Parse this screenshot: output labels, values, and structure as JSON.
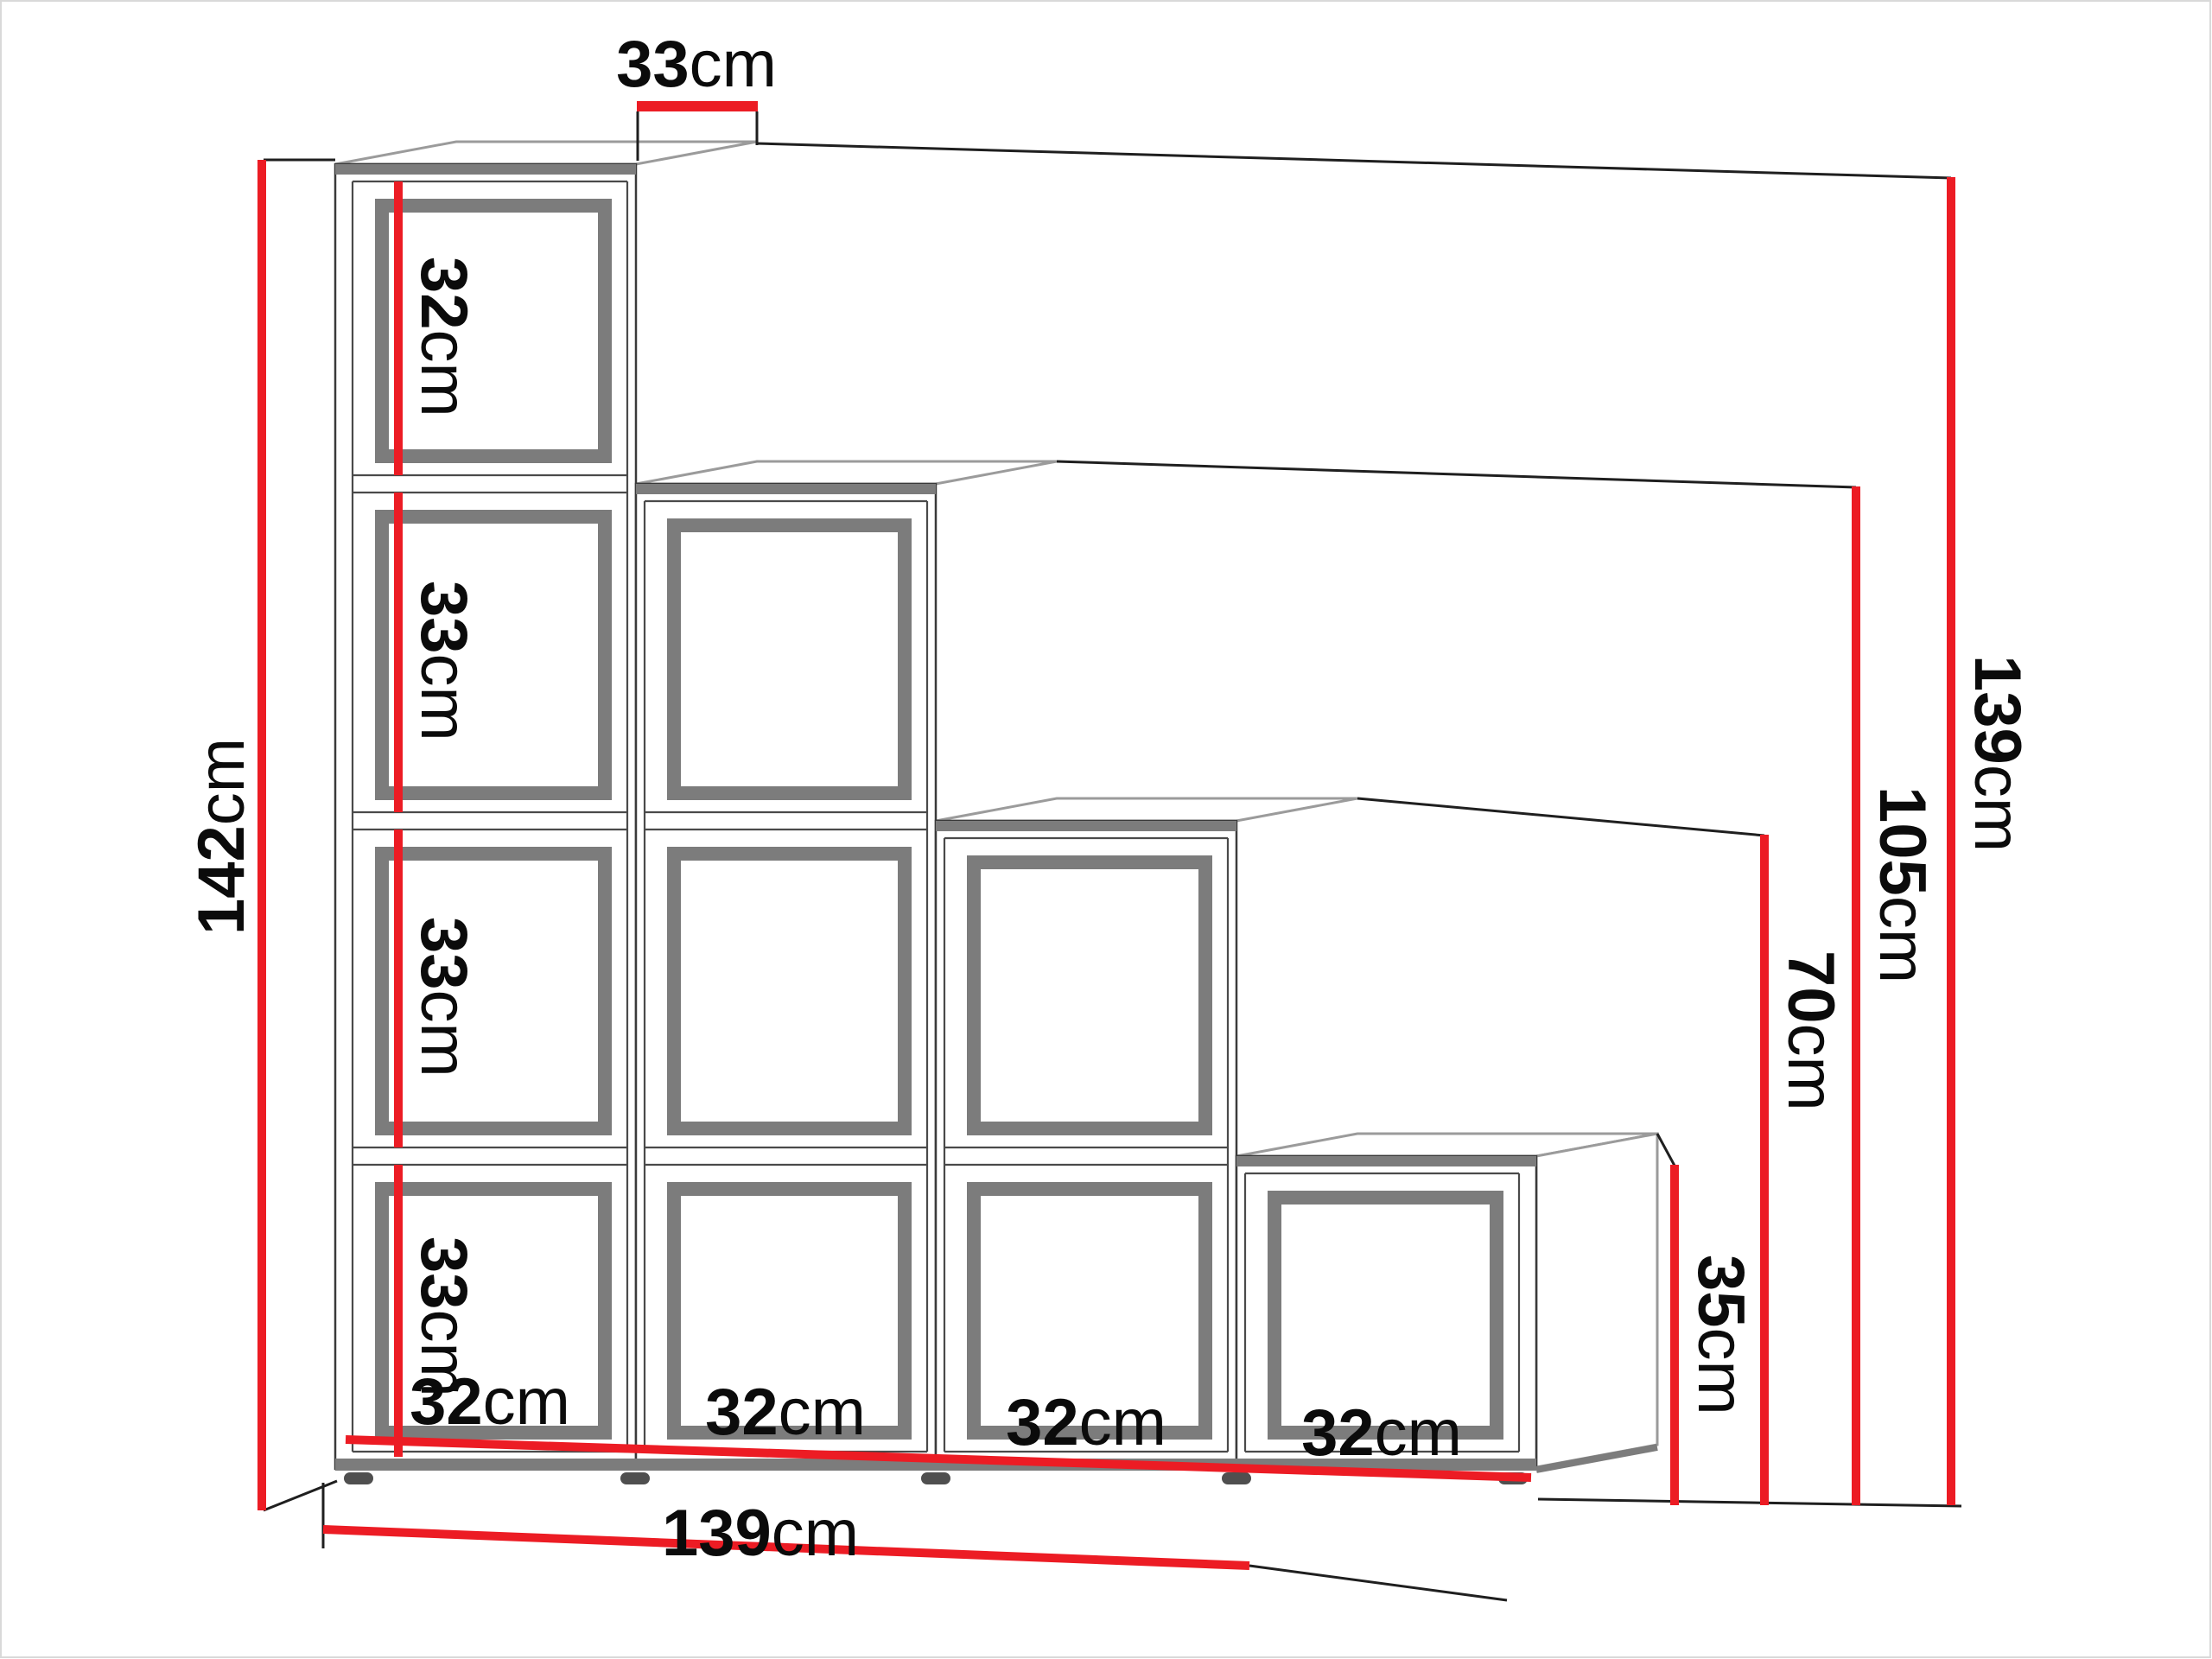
{
  "figure": {
    "kind": "furniture dimension diagram",
    "product": "staircase cube shelf (4 steps, 10 cubes)",
    "colors": {
      "dimension_red": "#ec1c24",
      "carcass_grey": "#7c7c7c",
      "edge_grey": "#9b9b9b",
      "line_black": "#1f1f1f",
      "background": "#ffffff"
    },
    "dims": {
      "depth_top": {
        "value": "33",
        "unit": "cm"
      },
      "height_total": {
        "value": "142",
        "unit": "cm"
      },
      "cube_heights": [
        {
          "value": "32",
          "unit": "cm"
        },
        {
          "value": "33",
          "unit": "cm"
        },
        {
          "value": "33",
          "unit": "cm"
        },
        {
          "value": "33",
          "unit": "cm"
        }
      ],
      "step_heights": [
        {
          "value": "139",
          "unit": "cm"
        },
        {
          "value": "105",
          "unit": "cm"
        },
        {
          "value": "70",
          "unit": "cm"
        },
        {
          "value": "35",
          "unit": "cm"
        }
      ],
      "cube_widths": [
        {
          "value": "32",
          "unit": "cm"
        },
        {
          "value": "32",
          "unit": "cm"
        },
        {
          "value": "32",
          "unit": "cm"
        },
        {
          "value": "32",
          "unit": "cm"
        }
      ],
      "width_total": {
        "value": "139",
        "unit": "cm"
      }
    }
  }
}
